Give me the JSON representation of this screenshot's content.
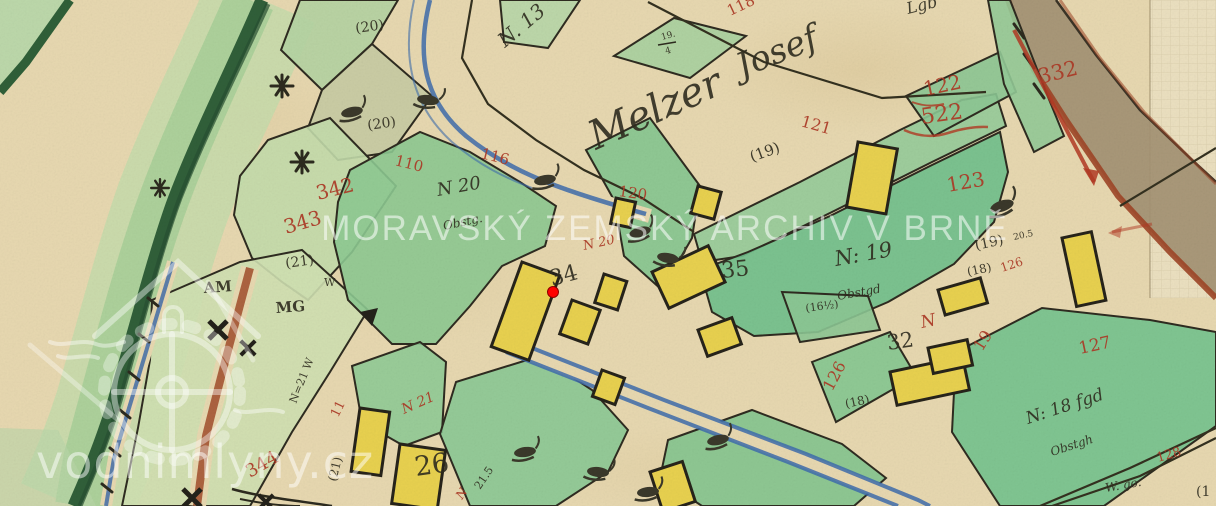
{
  "watermarks": {
    "archive": "MORAVSKÝ ZEMSKÝ ARCHIV V BRNĚ",
    "site": "vodnimlyny.cz",
    "logo": "watermill-house-logo"
  },
  "marker": {
    "x": 553,
    "y": 292,
    "color": "#ff0000"
  },
  "palette": {
    "paper": "#e7d8b0",
    "parcel_green": "#8dc991",
    "dark_green_bank": "#305f39",
    "building_yellow": "#e8d14f",
    "red_ink": "#ad3a26",
    "black_ink": "#2f2c1f",
    "stream_blue": "#3e6cab",
    "road_fill": "#a39173",
    "road_edge": "#9d4526"
  },
  "map_labels": [
    {
      "t": "118",
      "x": 730,
      "y": 16,
      "r": -25,
      "s": 15,
      "c": "r"
    },
    {
      "t": "110",
      "x": 394,
      "y": 165,
      "r": 14,
      "s": 15,
      "c": "r"
    },
    {
      "t": "116",
      "x": 480,
      "y": 158,
      "r": 14,
      "s": 15,
      "c": "r"
    },
    {
      "t": "342",
      "x": 318,
      "y": 200,
      "r": -14,
      "s": 20,
      "c": "r"
    },
    {
      "t": "343",
      "x": 286,
      "y": 234,
      "r": -16,
      "s": 20,
      "c": "r"
    },
    {
      "t": "344",
      "x": 250,
      "y": 478,
      "r": -30,
      "s": 18,
      "c": "r"
    },
    {
      "t": "120",
      "x": 618,
      "y": 196,
      "r": 8,
      "s": 15,
      "c": "r"
    },
    {
      "t": "N 20",
      "x": 584,
      "y": 250,
      "r": -12,
      "s": 13,
      "c": "r",
      "i": 1
    },
    {
      "t": "121",
      "x": 800,
      "y": 126,
      "r": 16,
      "s": 16,
      "c": "r"
    },
    {
      "t": "122",
      "x": 925,
      "y": 96,
      "r": -12,
      "s": 20,
      "c": "r"
    },
    {
      "t": "522",
      "x": 922,
      "y": 124,
      "r": -8,
      "s": 22,
      "c": "r"
    },
    {
      "t": "332",
      "x": 1040,
      "y": 84,
      "r": -14,
      "s": 21,
      "c": "r"
    },
    {
      "t": "123",
      "x": 948,
      "y": 192,
      "r": -10,
      "s": 20,
      "c": "r"
    },
    {
      "t": "126",
      "x": 832,
      "y": 392,
      "r": -62,
      "s": 16,
      "c": "r"
    },
    {
      "t": "126",
      "x": 1002,
      "y": 272,
      "r": -18,
      "s": 12,
      "c": "r"
    },
    {
      "t": "19",
      "x": 982,
      "y": 352,
      "r": -58,
      "s": 16,
      "c": "r"
    },
    {
      "t": "127",
      "x": 1080,
      "y": 354,
      "r": -12,
      "s": 17,
      "c": "r"
    },
    {
      "t": "N",
      "x": 922,
      "y": 328,
      "r": -12,
      "s": 17,
      "c": "r",
      "i": 1
    },
    {
      "t": "128",
      "x": 1158,
      "y": 462,
      "r": -16,
      "s": 13,
      "c": "r"
    },
    {
      "t": "N 21",
      "x": 404,
      "y": 414,
      "r": -24,
      "s": 14,
      "c": "r",
      "i": 1
    },
    {
      "t": "11",
      "x": 338,
      "y": 418,
      "r": -64,
      "s": 13,
      "c": "r"
    },
    {
      "t": "N",
      "x": 462,
      "y": 500,
      "r": -56,
      "s": 12,
      "c": "r",
      "i": 1
    },
    {
      "t": "(20)",
      "x": 356,
      "y": 33,
      "r": -8,
      "s": 14,
      "c": "k"
    },
    {
      "t": "(20)",
      "x": 368,
      "y": 130,
      "r": -8,
      "s": 14,
      "c": "k"
    },
    {
      "t": "N. 13",
      "x": 505,
      "y": 48,
      "r": -40,
      "s": 20,
      "c": "k",
      "i": 1
    },
    {
      "t": "19.",
      "x": 662,
      "y": 40,
      "r": -15,
      "s": 9,
      "c": "k"
    },
    {
      "t": "4",
      "x": 666,
      "y": 54,
      "r": -15,
      "s": 9,
      "c": "k"
    },
    {
      "t": "Melzer",
      "x": 596,
      "y": 150,
      "r": -24,
      "s": 40,
      "c": "k",
      "i": 1
    },
    {
      "t": "Josef",
      "x": 742,
      "y": 78,
      "r": -22,
      "s": 34,
      "c": "k",
      "i": 1
    },
    {
      "t": "Lgb",
      "x": 908,
      "y": 14,
      "r": -14,
      "s": 16,
      "c": "k",
      "i": 1
    },
    {
      "t": "(19)",
      "x": 752,
      "y": 162,
      "r": -20,
      "s": 15,
      "c": "k"
    },
    {
      "t": "N 20",
      "x": 438,
      "y": 196,
      "r": -10,
      "s": 18,
      "c": "k",
      "i": 1
    },
    {
      "t": "Obstg.",
      "x": 444,
      "y": 230,
      "r": -12,
      "s": 12,
      "c": "k",
      "i": 1
    },
    {
      "t": "34",
      "x": 552,
      "y": 286,
      "r": -15,
      "s": 22,
      "c": "k"
    },
    {
      "t": "35",
      "x": 722,
      "y": 278,
      "r": -6,
      "s": 22,
      "c": "k"
    },
    {
      "t": "N: 19",
      "x": 836,
      "y": 266,
      "r": -10,
      "s": 21,
      "c": "k",
      "i": 1
    },
    {
      "t": "Obstgd",
      "x": 838,
      "y": 300,
      "r": -10,
      "s": 12,
      "c": "k",
      "i": 1
    },
    {
      "t": "(19)",
      "x": 976,
      "y": 250,
      "r": -12,
      "s": 14,
      "c": "k"
    },
    {
      "t": "20.5",
      "x": 1014,
      "y": 240,
      "r": -12,
      "s": 9,
      "c": "k"
    },
    {
      "t": "(18)",
      "x": 968,
      "y": 276,
      "r": -12,
      "s": 12,
      "c": "k"
    },
    {
      "t": "(16½)",
      "x": 806,
      "y": 312,
      "r": -8,
      "s": 11,
      "c": "k"
    },
    {
      "t": "(18)",
      "x": 846,
      "y": 408,
      "r": -12,
      "s": 12,
      "c": "k"
    },
    {
      "t": "32",
      "x": 888,
      "y": 350,
      "r": -8,
      "s": 21,
      "c": "k"
    },
    {
      "t": "26",
      "x": 416,
      "y": 476,
      "r": -8,
      "s": 27,
      "c": "k"
    },
    {
      "t": "(21)",
      "x": 336,
      "y": 482,
      "r": -76,
      "s": 12,
      "c": "k"
    },
    {
      "t": "21.5",
      "x": 480,
      "y": 490,
      "r": -56,
      "s": 11,
      "c": "k"
    },
    {
      "t": "(21)",
      "x": 286,
      "y": 268,
      "r": -8,
      "s": 14,
      "c": "k"
    },
    {
      "t": "W",
      "x": 324,
      "y": 286,
      "r": 0,
      "s": 11,
      "c": "k"
    },
    {
      "t": "AM",
      "x": 204,
      "y": 293,
      "r": -4,
      "s": 15,
      "c": "k",
      "b": 1
    },
    {
      "t": "MG",
      "x": 276,
      "y": 313,
      "r": -4,
      "s": 15,
      "c": "k",
      "b": 1
    },
    {
      "t": "N=21 W",
      "x": 296,
      "y": 404,
      "r": -68,
      "s": 11,
      "c": "k"
    },
    {
      "t": "N: 18 fgd",
      "x": 1028,
      "y": 424,
      "r": -18,
      "s": 17,
      "c": "k",
      "i": 1
    },
    {
      "t": "Obstgh",
      "x": 1052,
      "y": 456,
      "r": -18,
      "s": 12,
      "c": "k",
      "i": 1
    },
    {
      "t": "W. go.",
      "x": 1106,
      "y": 492,
      "r": -10,
      "s": 12,
      "c": "k",
      "i": 1
    },
    {
      "t": "(1",
      "x": 1196,
      "y": 496,
      "r": 0,
      "s": 14,
      "c": "k"
    }
  ]
}
